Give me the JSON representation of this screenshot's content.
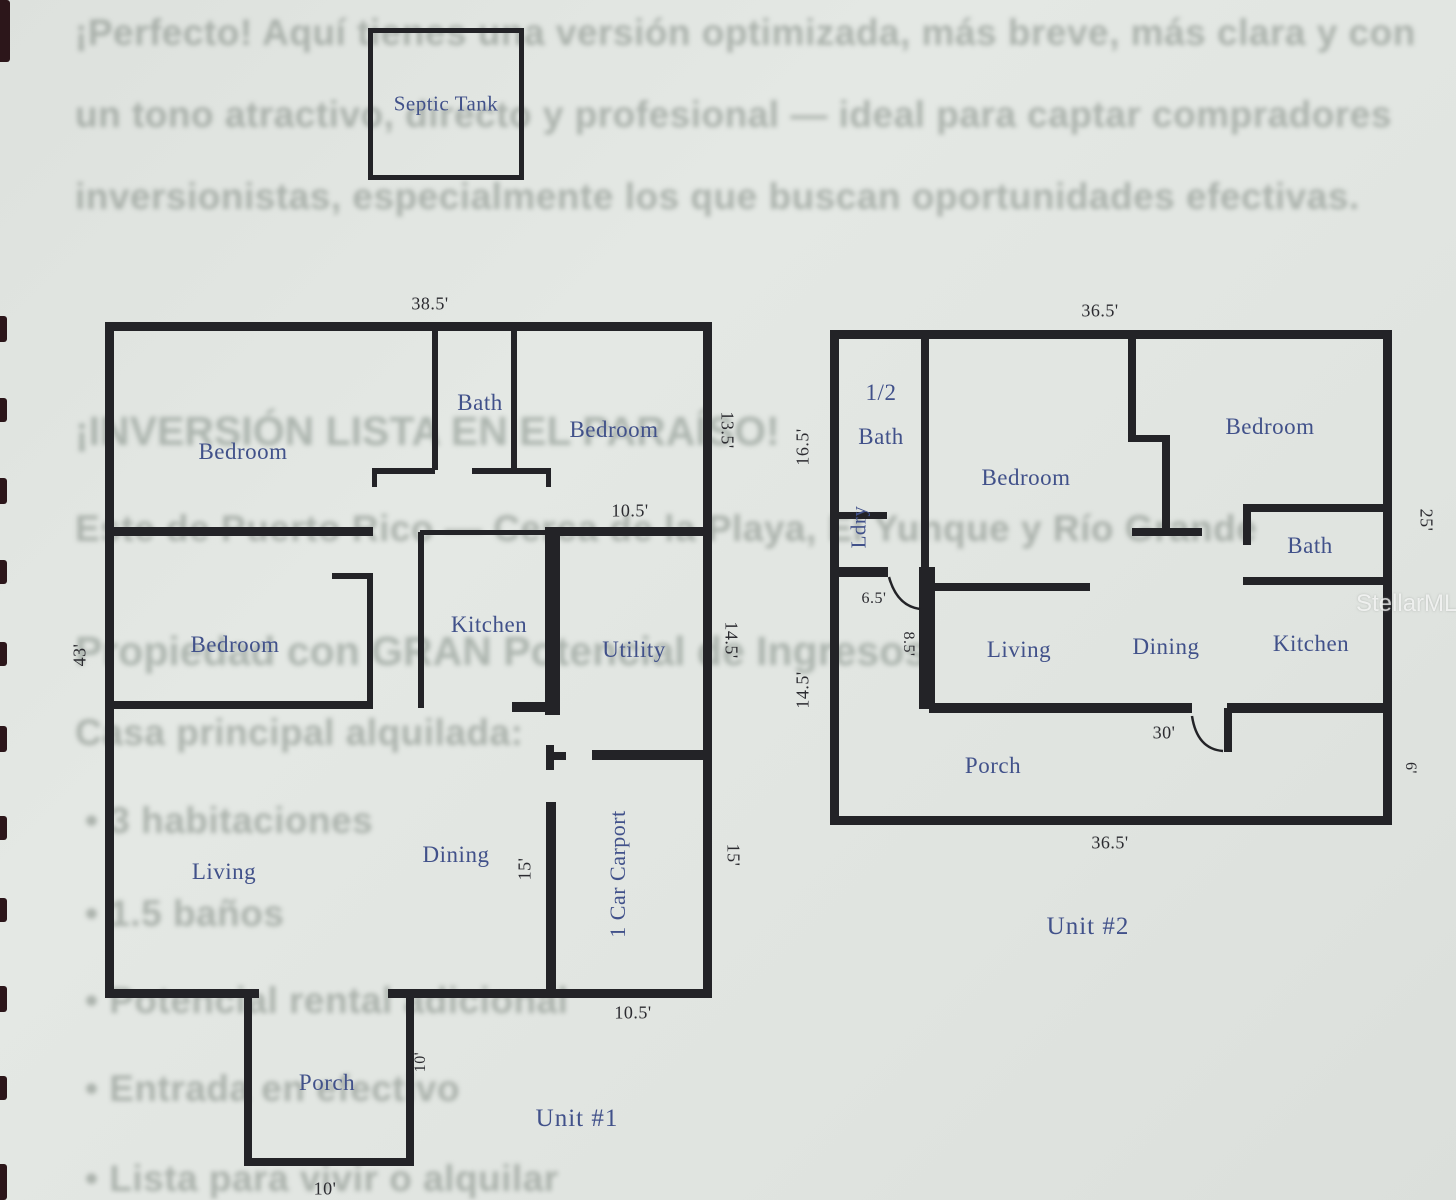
{
  "page": {
    "watermark": "StellarMLS"
  },
  "septic_tank": {
    "label": "Septic Tank"
  },
  "unit1": {
    "name": "Unit #1",
    "rooms": {
      "bedroom_top_left": "Bedroom",
      "bath": "Bath",
      "bedroom_top_right": "Bedroom",
      "bedroom_middle": "Bedroom",
      "kitchen": "Kitchen",
      "utility": "Utility",
      "living": "Living",
      "dining": "Dining",
      "carport": "1 Car Carport",
      "porch": "Porch"
    },
    "dims": {
      "top_width": "38.5'",
      "left_height": "43'",
      "right_top": "13.5'",
      "hall_width": "10.5'",
      "right_middle": "14.5'",
      "dining_height": "15'",
      "right_bottom": "15'",
      "carport_width": "10.5'",
      "porch_depth": "10'",
      "porch_width": "10'"
    }
  },
  "unit2": {
    "name": "Unit #2",
    "rooms": {
      "half_bath_line1": "1/2",
      "half_bath_line2": "Bath",
      "laundry": "Ldry",
      "bedroom_left": "Bedroom",
      "bedroom_right": "Bedroom",
      "bath": "Bath",
      "living": "Living",
      "dining": "Dining",
      "kitchen": "Kitchen",
      "porch": "Porch"
    },
    "dims": {
      "top_width": "36.5'",
      "left_upper": "16.5'",
      "left_lower": "14.5'",
      "laundry_door": "6.5'",
      "hall": "8.5'",
      "right_height": "25'",
      "porch_span": "30'",
      "porch_depth": "6'",
      "bottom_width": "36.5'"
    }
  },
  "background_text": {
    "para1": "¡Perfecto! Aquí tienes una versión optimizada, más breve, más clara y con",
    "para2": "un tono atractivo, directo y profesional — ideal para captar compradores",
    "para3": "inversionistas, especialmente los que buscan oportunidades efectivas.",
    "heading": "¡INVERSIÓN LISTA EN EL PARAÍSO!",
    "location": "Este de Puerto Rico — Cerca de la Playa, El Yunque y Río Grande",
    "subheading": "Propiedad con GRAN Potencial de Ingresos",
    "line_casa": "Casa principal alquilada:",
    "bullet1": "• 3 habitaciones",
    "bullet2": "• 1.5 baños",
    "bullet3": "• Potencial rental adicional",
    "bullet4": "• Entrada en efectivo",
    "bullet5": "• Lista para vivir o alquilar"
  },
  "colors": {
    "wall": "#232327",
    "room_label": "#41518a",
    "dim_label": "#2b2b30",
    "paper": "#e1e5e1"
  }
}
